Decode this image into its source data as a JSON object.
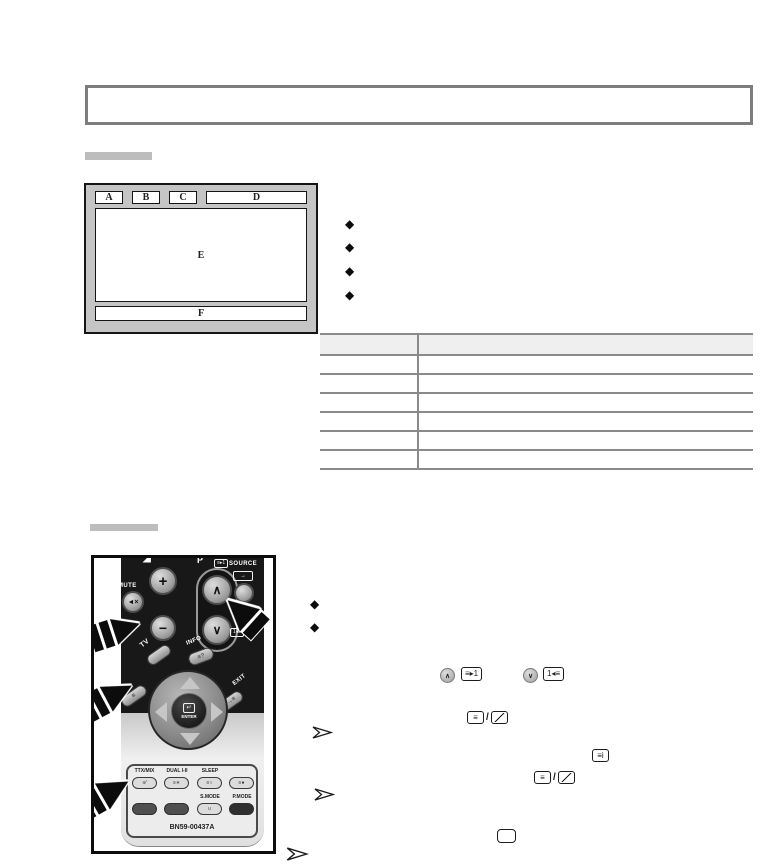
{
  "glyphs": {
    "diamond": "◆",
    "chevron_up": "∧",
    "chevron_down": "∨",
    "volume_wedge": "◢"
  },
  "diagram": {
    "label_a": "A",
    "label_b": "B",
    "label_c": "C",
    "label_d": "D",
    "label_e": "E",
    "label_f": "F"
  },
  "table": {
    "columns": 2,
    "data_rows": 6
  },
  "remote": {
    "p_label": "P",
    "plus": "+",
    "minus": "−",
    "mute": "MUTE",
    "mute_icon": "◄×",
    "source": "SOURCE",
    "source_icon": "→",
    "tv": "TV",
    "menu": "MENU",
    "menu_icon": "≡",
    "info": "INFO",
    "info_icon": "≡?",
    "exit": "EXIT",
    "exit_icon": "→≡",
    "enter": "ENTER",
    "enter_icon": "↵",
    "page_up_icon": "≡▸1",
    "page_down_icon": "1◂≡",
    "ttx_mix": "TTX/MIX",
    "dual": "DUAL I-II",
    "sleep": "SLEEP",
    "s_mode": "S.MODE",
    "p_mode": "P.MODE",
    "s_mode_icon": "∪",
    "ttx_btn_icon": "≡⁄",
    "dual_btn_icon": "≡∗",
    "sleep_btn_icon": "≡○",
    "fourth_btn_icon": "≡●",
    "model": "BN59-00437A"
  },
  "inline_icons": {
    "page_up_circle": "∧",
    "page_down_circle": "∨",
    "next_page_box": "≡▸1",
    "prev_page_box": "1◂≡",
    "lines_box": "≡",
    "index_box": "≡i",
    "slash": "/"
  },
  "colors": {
    "title_border": "#7d7d7d",
    "section_bar": "#bdbdbd",
    "diagram_frame": "#c5c5c5",
    "table_line": "#8a8a8a",
    "table_header_fill": "#efefef",
    "remote_body": "#181818",
    "ink": "#111111"
  }
}
